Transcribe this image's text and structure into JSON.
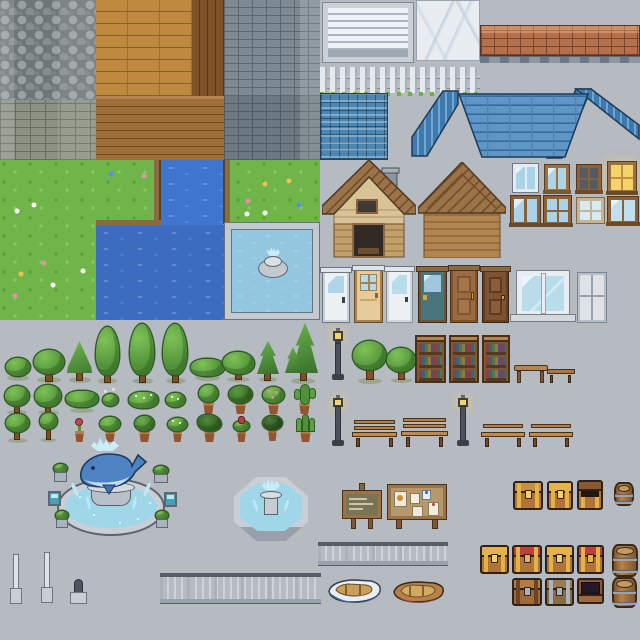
{
  "sheet": {
    "kind": "pixel-art tileset sprite sheet",
    "theme": "town / village exterior pack",
    "canvas": "640x640"
  },
  "palette": {
    "background": "#b6bac1",
    "grass": "#6fb54a",
    "water_deep": "#3b6cc0",
    "pool_water": "#93c6df",
    "roof_blue": "#5e97c7",
    "shingle_blue": "#4c87b3",
    "wood_plank": "#c08a3e",
    "wood_dark": "#7c5226",
    "gray_brick": "#7e8a93",
    "red_brick": "#b4714c",
    "cobblestone": "#8d9496",
    "marble": "#e9edf2",
    "house_wood": "#b2854e",
    "tree_green": "#4f9038",
    "chest_gold": "#e3b348",
    "chest_red": "#c13e3e",
    "whale_blue": "#4d83c3",
    "stone_trim": "#c9cfd7",
    "lamp_glow": "#f2d36e"
  },
  "groups": {
    "tiles": {
      "label": "Wall and floor tiles",
      "items": [
        "cobblestone wall",
        "stone brick wall",
        "wood plank wall",
        "dark plank trim",
        "dark wood floor",
        "gray brick wall",
        "white siding panel",
        "marble tile",
        "red brick wall cap",
        "white picket fence",
        "blue shingle tile",
        "blue hip roof"
      ]
    },
    "terrain": {
      "label": "Terrain tiles",
      "items": [
        "flower grass",
        "river",
        "lake water",
        "dirt banks",
        "stone-edged pool with fountain"
      ]
    },
    "buildings": {
      "label": "Buildings",
      "items": [
        "wooden cottage with door, window and chimney",
        "wooden barn facade"
      ]
    },
    "windows": {
      "label": "Windows",
      "items": [
        "white frame window",
        "brown two-pane window",
        "brown four-pane dark window",
        "lit yellow window",
        "brown double window",
        "brown four-pane window",
        "pale four-pane window",
        "blue two-pane window"
      ]
    },
    "doors": {
      "label": "Doors",
      "items": [
        "white glazed door",
        "tan glazed door",
        "white door",
        "teal glazed door",
        "brown panel door",
        "dark brown door",
        "storefront window",
        "gray panel door"
      ]
    },
    "vegetation": {
      "label": "Trees, bushes and potted plants",
      "items": [
        "small bush",
        "round tree",
        "conical tree",
        "poplar tree x3",
        "wide hedge",
        "bushy tree",
        "pine tree",
        "double pine",
        "round trees",
        "flowering bushes",
        "potted bush",
        "potted plant",
        "potted pink flowers",
        "potted cactus",
        "potted flower",
        "potted herbs",
        "potted aloe"
      ]
    },
    "furniture": {
      "label": "Street and home furniture",
      "items": [
        "street lamp x3",
        "park tree x2",
        "bookshelf x3",
        "wooden table",
        "small bench",
        "park bench with back x2",
        "low bench x2"
      ]
    },
    "fountains": {
      "label": "Fountains",
      "items": [
        "whale statue fountain with planters",
        "octagonal stone fountain"
      ]
    },
    "signs": {
      "label": "Signs",
      "items": [
        "wooden signpost",
        "notice board with pinned papers"
      ]
    },
    "storage": {
      "label": "Chests and barrels",
      "items": [
        "gold-trim chest",
        "gold chest open",
        "small barrel",
        "gold-band chest x2",
        "red-lid chest x2",
        "plain wood chest",
        "silver-trim chest",
        "open dark chest",
        "barrel x2"
      ]
    },
    "transport": {
      "label": "Boats and rails",
      "items": [
        "metal railing x2",
        "white rowboat",
        "wooden rowboat"
      ]
    },
    "misc": {
      "label": "Misc props",
      "items": [
        "signal pole x2",
        "bollard"
      ]
    }
  }
}
